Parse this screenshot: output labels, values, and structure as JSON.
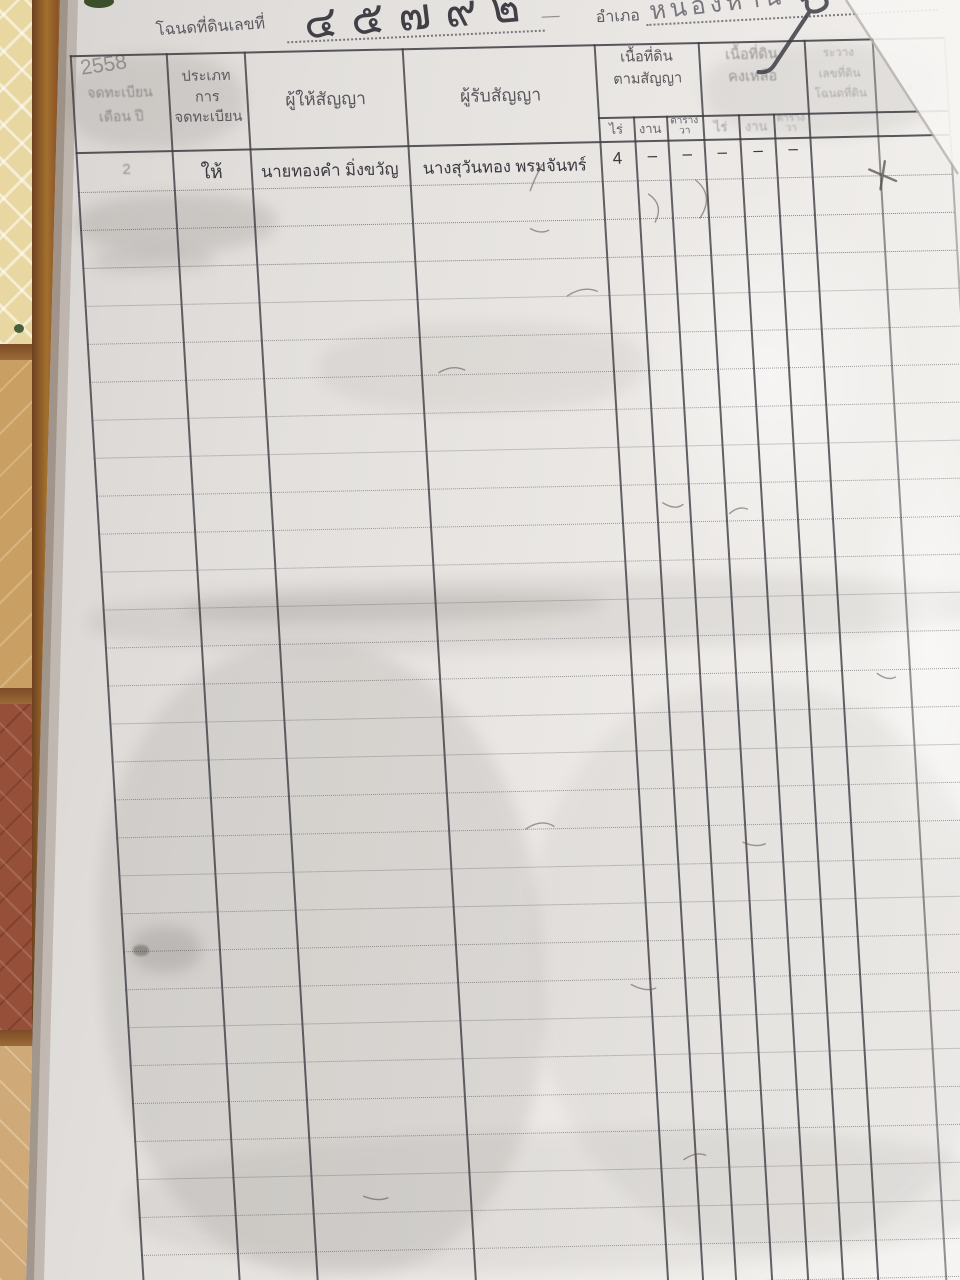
{
  "header": {
    "deed_label": "โฉนดที่ดินเลขที่",
    "deed_number": "๔๕๗๙๒",
    "separator_dash": "—",
    "district_label": "อำเภอ",
    "district_value": "หนองหาน",
    "year_note": "2558"
  },
  "table": {
    "headers": {
      "col_register": [
        "จดทะเบียน",
        "เดือน ปี"
      ],
      "col_type": [
        "ประเภท",
        "การ",
        "จดทะเบียน"
      ],
      "col_grantor": "ผู้ให้สัญญา",
      "col_grantee": "ผู้รับสัญญา",
      "group_area_contract": [
        "เนื้อที่ดิน",
        "ตามสัญญา"
      ],
      "group_area_remaining": [
        "เนื้อที่ดิน",
        "คงเหลือ"
      ],
      "unit_rai": "ไร่",
      "unit_ngan": "งาน",
      "unit_sq_wa": [
        "ตาราง",
        "วา"
      ],
      "col_map": [
        "ระวาง",
        "เลขที่ดิน",
        "โฉนดที่ดิน"
      ],
      "col_last": "ล"
    },
    "entry": {
      "date_note": "2",
      "type": "ให้",
      "grantor": "นายทองคำ  มิ่งขวัญ",
      "grantee": "นางสุวันทอง  พรมจันทร์",
      "rai": "4",
      "ngan": "–",
      "sq_wa": "–",
      "rem_rai": "–",
      "rem_ngan": "–",
      "rem_sq_wa": "–"
    },
    "empty_row_count": 30
  },
  "colors": {
    "paper": "#eae7e4",
    "ink": "#3d3c42",
    "pencil_handwriting": "#34333b",
    "floor_tile_yellow": "#e8d7a0",
    "floor_tile_red": "#96503a",
    "grout_brown": "#9a6a38"
  }
}
